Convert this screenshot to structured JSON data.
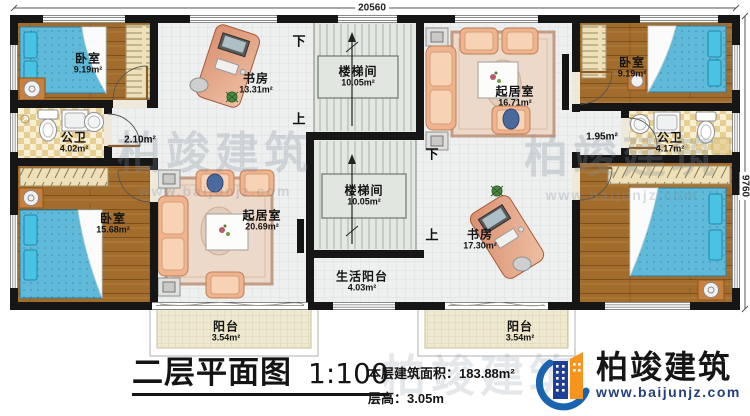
{
  "plan": {
    "rooms": {
      "bedroom_tl": {
        "name": "卧室",
        "area": "9.19m²"
      },
      "study_tl": {
        "name": "书房",
        "area": "13.31m²"
      },
      "stair_top": {
        "name": "楼梯间",
        "area": "10.05m²"
      },
      "living_tr": {
        "name": "起居室",
        "area": "16.71m²"
      },
      "bedroom_tr": {
        "name": "卧室",
        "area": "9.19m²"
      },
      "bath_left": {
        "name": "公卫",
        "area": "4.02m²"
      },
      "hall_left": {
        "area": "2.10m²"
      },
      "hall_right": {
        "area": "1.95m²"
      },
      "bath_right": {
        "name": "公卫",
        "area": "4.17m²"
      },
      "bedroom_bl": {
        "name": "卧室",
        "area": "15.68m²"
      },
      "living_bl": {
        "name": "起居室",
        "area": "20.69m²"
      },
      "stair_bottom": {
        "name": "楼梯间",
        "area": "10.05m²"
      },
      "study_br": {
        "name": "书房",
        "area": "17.30m²"
      },
      "service_balcony": {
        "name": "生活阳台",
        "area": "4.03m²"
      },
      "balcony_left": {
        "name": "阳台",
        "area": "3.54m²"
      },
      "balcony_right": {
        "name": "阳台",
        "area": "3.54m²"
      }
    },
    "stair_directions": {
      "up": "上",
      "down": "下"
    },
    "dimensions": {
      "width": "20560",
      "height": "9760"
    }
  },
  "titleblock": {
    "title": "二层平面图",
    "scale": "1:100",
    "floor_area_label": "本层建筑面积：",
    "floor_area_value": "183.88m²",
    "floor_height_label": "层高：",
    "floor_height_value": "3.05m"
  },
  "brand": {
    "name": "柏竣建筑",
    "website": "www.baijunjz.com"
  },
  "watermark": {
    "text": "柏竣建筑",
    "site": "www.baijunjz.com"
  },
  "colors": {
    "wall": "#161616",
    "wood_floor": "#a26d2c",
    "tile_floor": "#f7efd5",
    "open_floor": "#eef0ef",
    "stair_floor": "#e3e8e2",
    "balcony_floor": "#efe9d1",
    "bed_blue": "#5fb9d9",
    "sofa_peach": "#f1b28e",
    "desk_terracotta": "#d98f6f",
    "brand_blue": "#1a63ae",
    "brand_navy": "#1e3f95",
    "brand_orange": "#f7941d",
    "website_color": "#23407c"
  }
}
